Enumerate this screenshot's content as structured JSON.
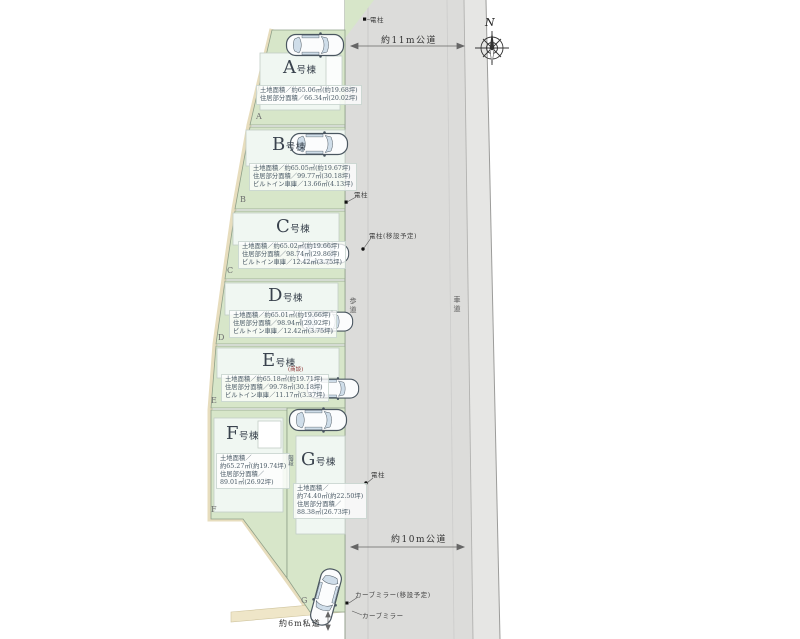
{
  "compass": {
    "north_label": "N"
  },
  "roads": {
    "top_public_road": "約11m公道",
    "bottom_public_road": "約10m公道",
    "private_road": "約6m私道",
    "sidewalk_label": "歩道",
    "roadway_label": "車道"
  },
  "annotations": {
    "pole_top": "電柱",
    "pole_mid": "電柱",
    "pole_relocate": "電柱(移設予定)",
    "pole_bottom": "電柱",
    "mirror_relocate": "カーブミラー(移設予定)",
    "mirror": "カーブミラー"
  },
  "lots": [
    {
      "name_letter": "A",
      "name_suffix": "号棟",
      "corner_letter": "A",
      "info": [
        "土地面積／約65.06㎡(約19.68坪)",
        "住居部分面積／66.34㎡(20.02坪)"
      ]
    },
    {
      "name_letter": "B",
      "name_suffix": "号棟",
      "corner_letter": "B",
      "info": [
        "土地面積／約65.05㎡(約19.67坪)",
        "住居部分面積／99.77㎡(30.18坪)",
        "ビルトイン車庫／13.66㎡(4.13坪)"
      ]
    },
    {
      "name_letter": "C",
      "name_suffix": "号棟",
      "corner_letter": "C",
      "info": [
        "土地面積／約65.02㎡(約19.66坪)",
        "住居部分面積／98.74㎡(29.86坪)",
        "ビルトイン車庫／12.42㎡(3.75坪)"
      ]
    },
    {
      "name_letter": "D",
      "name_suffix": "号棟",
      "corner_letter": "D",
      "info": [
        "土地面積／約65.01㎡(約19.66坪)",
        "住居部分面積／98.94㎡(29.92坪)",
        "ビルトイン車庫／12.42㎡(3.75坪)"
      ]
    },
    {
      "name_letter": "E",
      "name_suffix": "号棟",
      "note": "(商談)",
      "corner_letter": "E",
      "info": [
        "土地面積／約65.18㎡(約19.71坪)",
        "住居部分面積／99.78㎡(30.18坪)",
        "ビルトイン車庫／11.17㎡(3.37坪)"
      ]
    },
    {
      "name_letter": "F",
      "name_suffix": "号棟",
      "corner_letter": "F",
      "info": [
        "土地面積／",
        "約65.27㎡(約19.74坪)",
        "住居部分面積／",
        "89.01㎡(26.92坪)"
      ]
    },
    {
      "name_letter": "G",
      "name_suffix": "号棟",
      "side_note": "階段",
      "corner_letter": "G",
      "info": [
        "土地面積／",
        "約74.40㎡(約22.50坪)",
        "住居部分面積／",
        "88.38㎡(26.73坪)"
      ]
    }
  ]
}
